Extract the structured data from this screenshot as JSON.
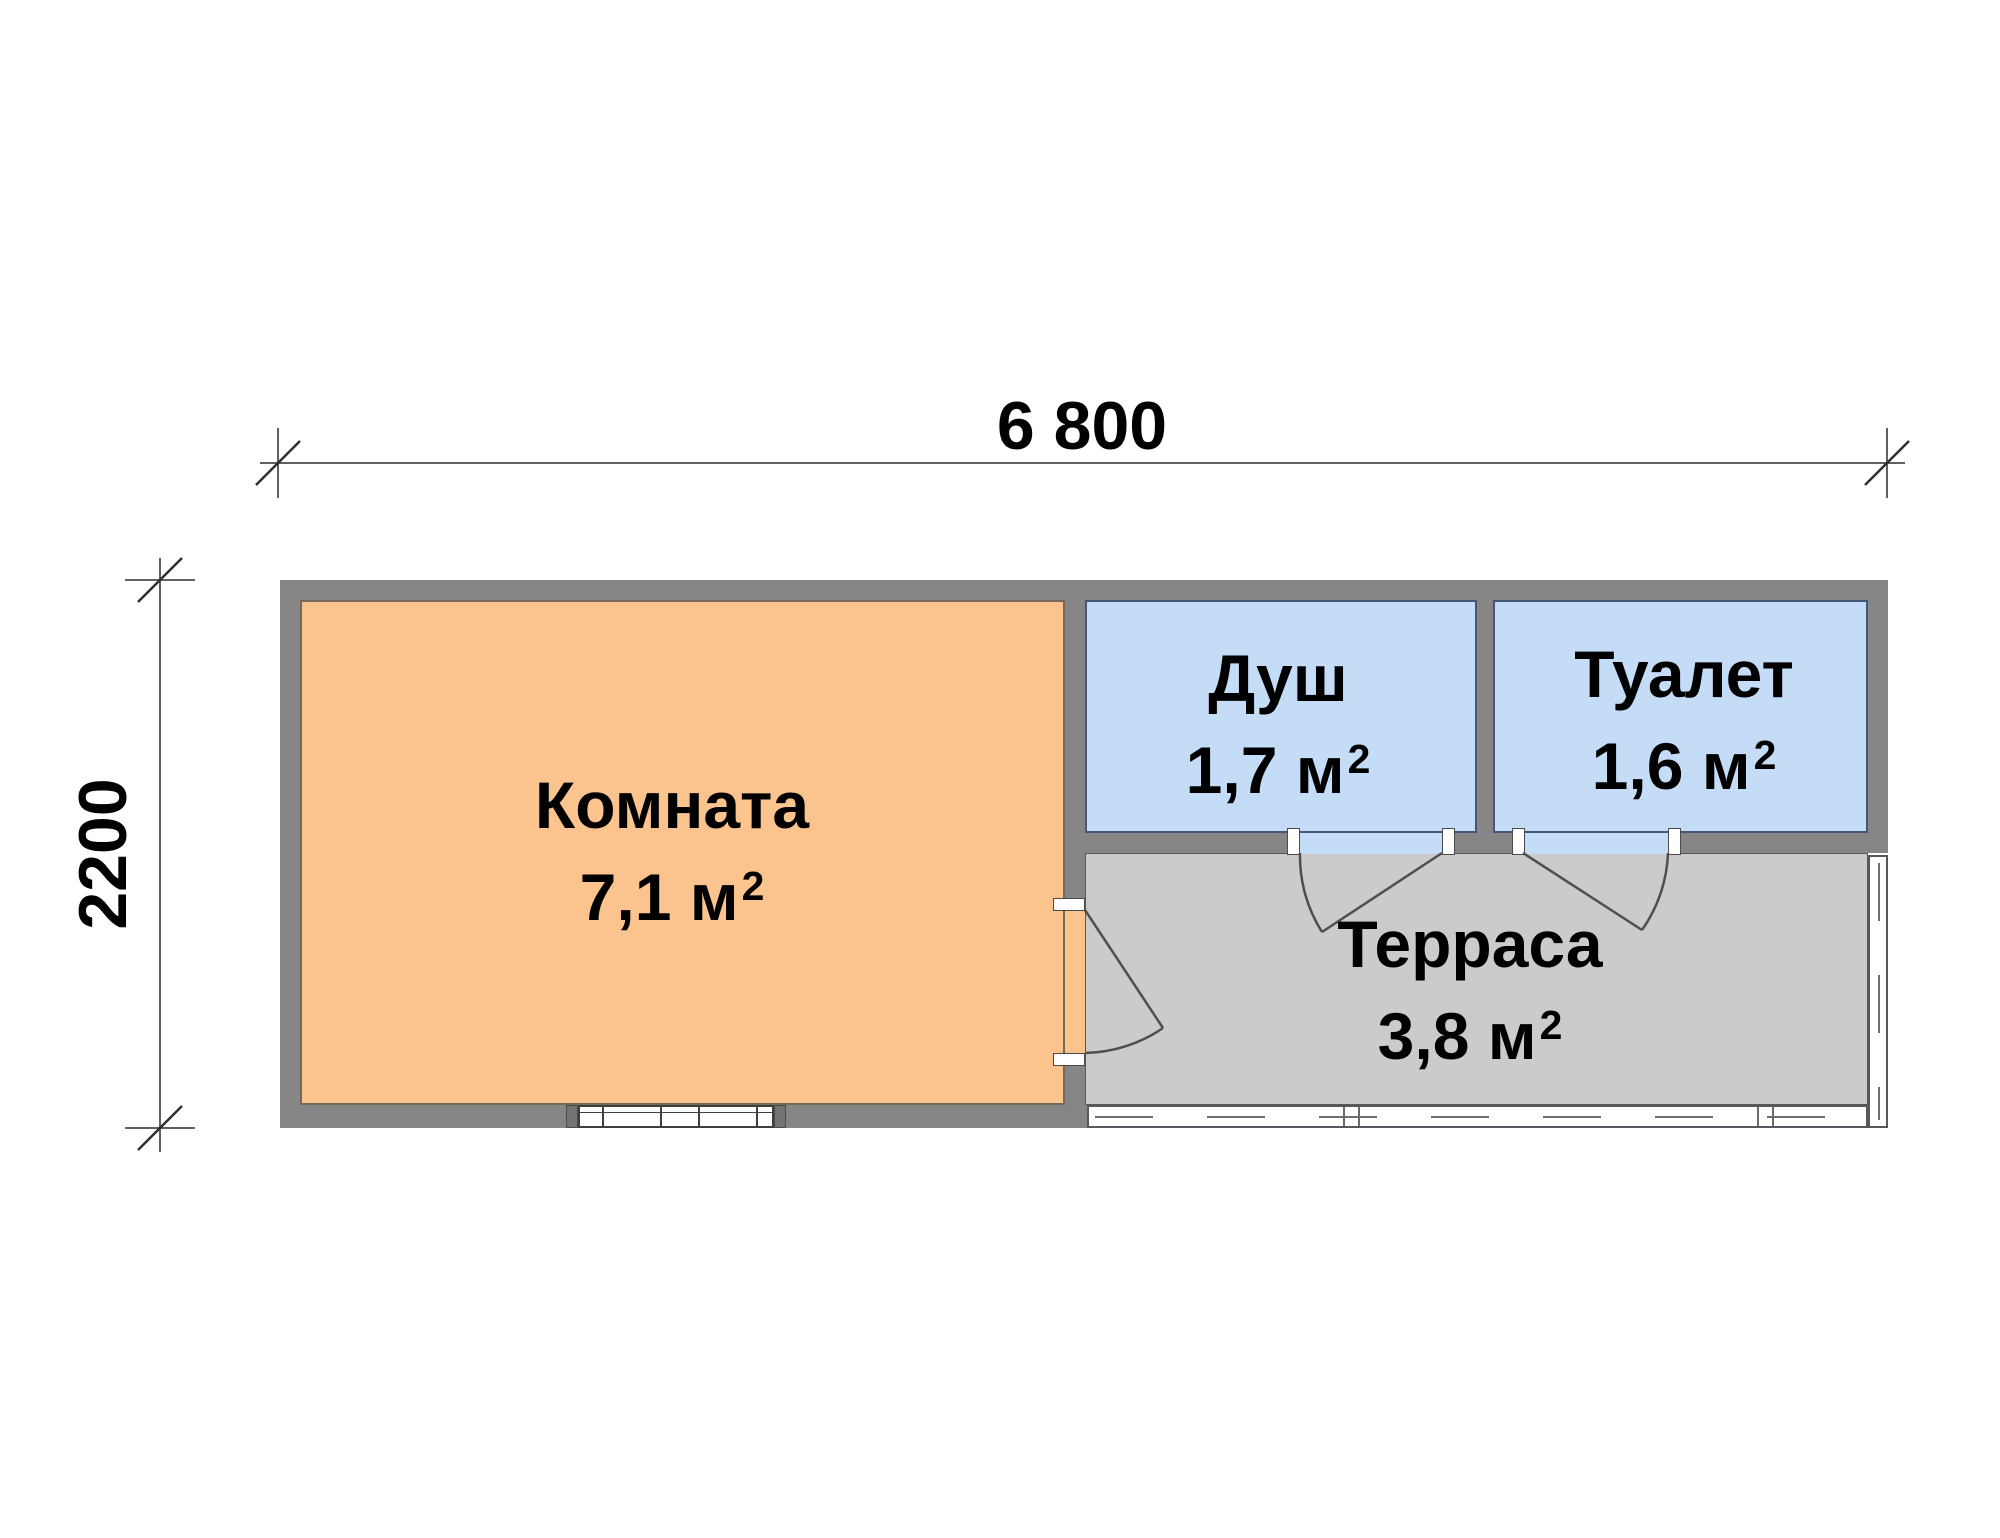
{
  "drawing": {
    "type": "floor-plan"
  },
  "dimensions": {
    "width_label": "6 800",
    "height_label": "2200"
  },
  "rooms": [
    {
      "name": "Комната",
      "area": "7,1 м",
      "area_exponent": "2"
    },
    {
      "name": "Душ",
      "area": "1,7 м",
      "area_exponent": "2"
    },
    {
      "name": "Туалет",
      "area": "1,6 м",
      "area_exponent": "2"
    },
    {
      "name": "Терраса",
      "area": "3,8 м",
      "area_exponent": "2"
    }
  ],
  "colors": {
    "wall": "#868686",
    "room_living_fill": "#FBC48E",
    "room_wet_fill": "#C5DCF7",
    "terrace_fill": "#CBCBCB",
    "outline_blue": "#46567B",
    "dimension_line": "#606060",
    "text": "#000000"
  }
}
